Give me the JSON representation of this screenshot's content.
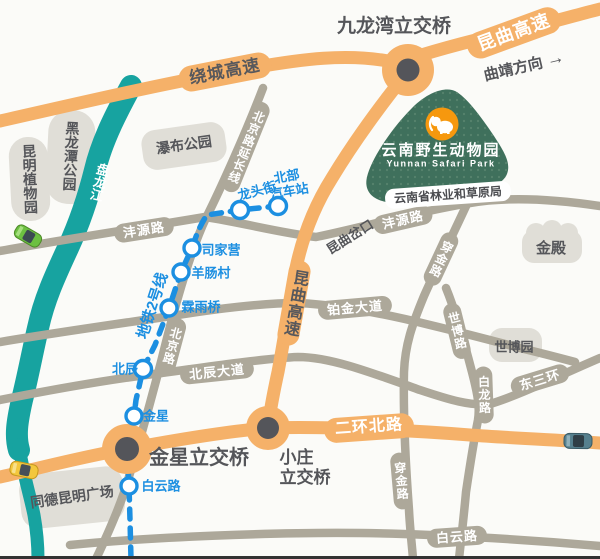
{
  "colors": {
    "highway_orange": "#F5B169",
    "road_gray": "#ADA89A",
    "river_teal": "#17A3A0",
    "metro_blue": "#1C8FE1",
    "park_green": "#3F705C",
    "logo_orange": "#F6980E",
    "dark_text": "#55565A",
    "blob_gray": "#E0DED7"
  },
  "highways": {
    "raocheng": "绕城高速",
    "kunqu_ne": "昆曲高速",
    "kunqu_south": "昆曲高速",
    "erhuan_north": "二环北路",
    "qujing_direction": "曲靖方向",
    "direction_arrow": "→"
  },
  "interchanges": {
    "jiulongwan": "九龙湾立交桥",
    "jinxing": "金星立交桥",
    "xiaozhuang_line1": "小庄",
    "xiaozhuang_line2": "立交桥"
  },
  "roads": {
    "fengyuan_west": "沣源路",
    "fengyuan_east": "沣源路",
    "beijing_extension": "北京路延长线",
    "beijing": "北京路",
    "beichen_avenue": "北辰大道",
    "bojin_avenue": "铂金大道",
    "chuanjin_north": "穿金路",
    "chuanjin_south": "穿金路",
    "shibo_road": "世博路",
    "bailong_road": "白龙路",
    "dongsanhuan": "东三环",
    "baiyun_road": "白云路"
  },
  "metro": {
    "line_name": "地铁2号线",
    "stations": {
      "longtoujie": "龙头街",
      "beibu_line1": "北部",
      "beibu_line2": "汽车站",
      "sijiaying": "司家营",
      "yangchangcun": "羊肠村",
      "linyuqiao": "霖雨桥",
      "beichen": "北辰",
      "jinxing": "金星",
      "baiyunlu": "白云路"
    }
  },
  "places": {
    "heilongtan_park": "黑龙潭公园",
    "botanical_garden": "昆明植物园",
    "waterfall_park": "瀑布公园",
    "panlong_river": "盘龙江",
    "kunqu_fork": "昆曲岔口",
    "golden_temple": "金殿",
    "expo_garden": "世博园",
    "tongde_plaza": "同德昆明广场",
    "forestry_bureau": "云南省林业和草原局"
  },
  "park": {
    "name_cn": "云南野生动物园",
    "name_en": "Yunnan Safari Park"
  }
}
